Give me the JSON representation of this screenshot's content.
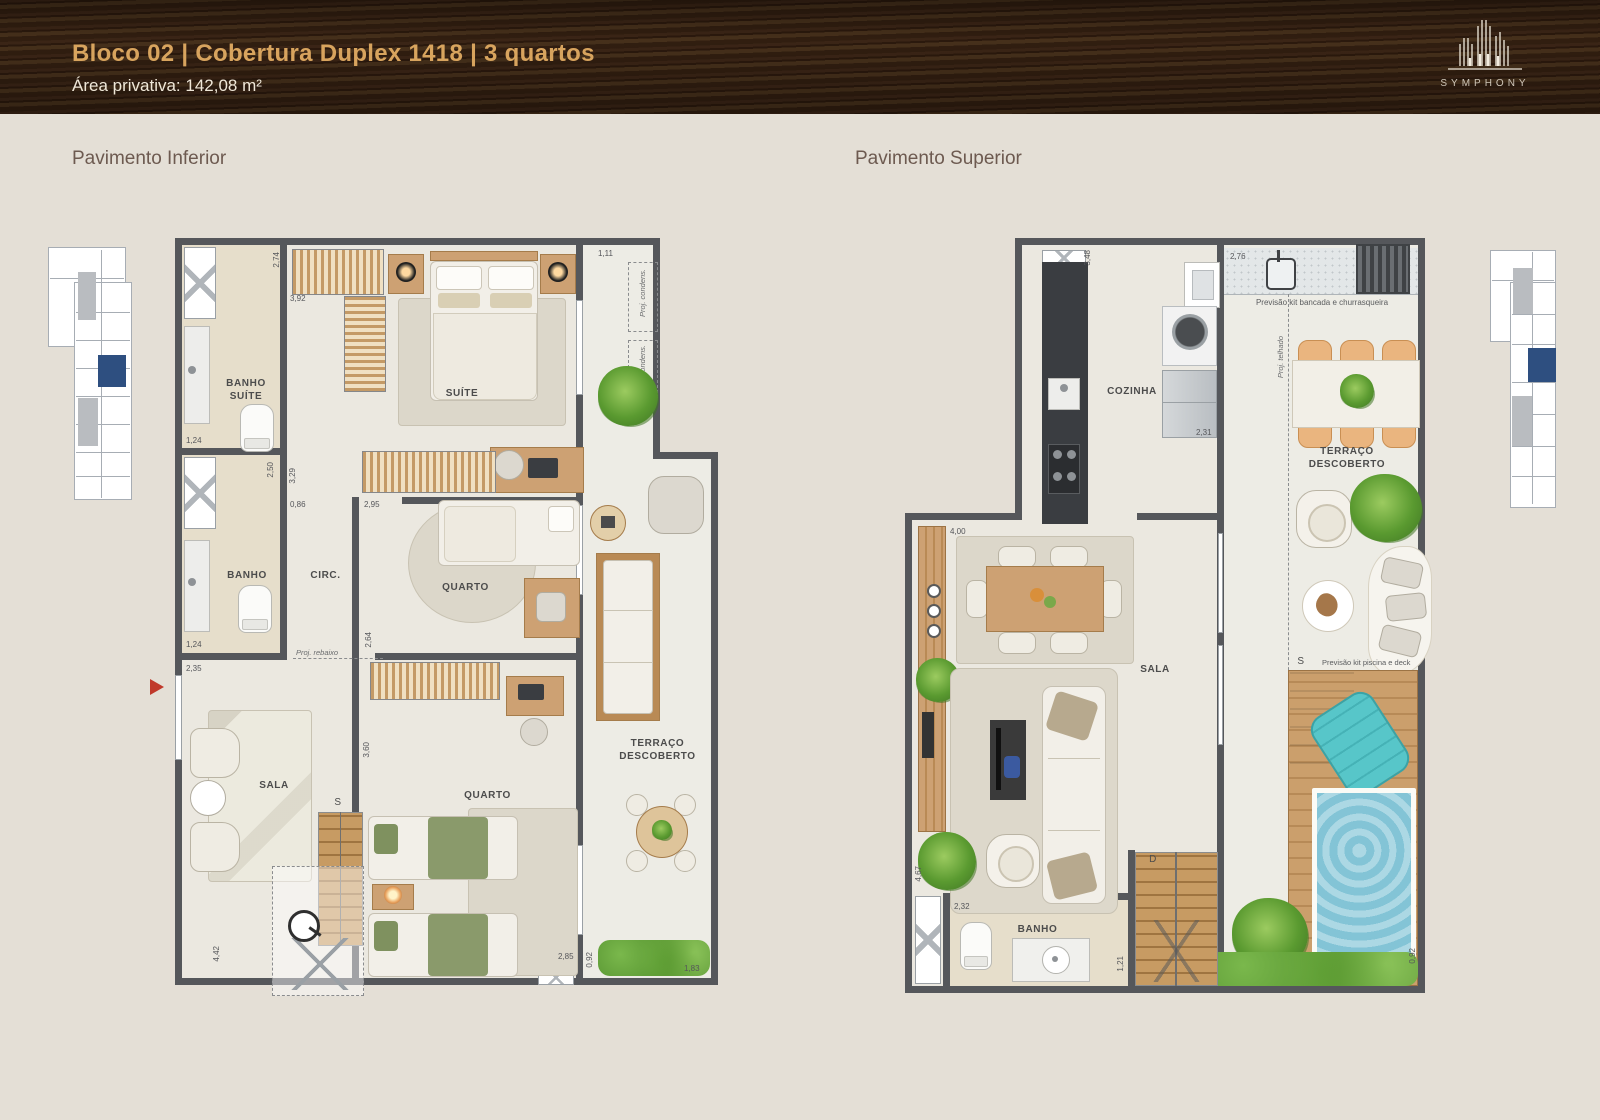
{
  "header": {
    "title": "Bloco 02 | Cobertura Duplex 1418 | 3 quartos",
    "subtitle": "Área privativa: 142,08 m²",
    "brand": "SYMPHONY"
  },
  "sections": {
    "inferior_title": "Pavimento Inferior",
    "superior_title": "Pavimento Superior"
  },
  "colors": {
    "header_gold": "#d8a45e",
    "keyplan_highlight": "#2e4f80",
    "pool_water": "#8cc9da",
    "entry_arrow_red": "#c0392b"
  },
  "inferior": {
    "rooms": {
      "banho_suite": "BANHO\nSUÍTE",
      "suite": "SUÍTE",
      "banho": "BANHO",
      "circ": "CIRC.",
      "quarto1": "QUARTO",
      "quarto2": "QUARTO",
      "sala": "SALA",
      "terraco": "TERRAÇO\nDESCOBERTO",
      "stair_s": "S"
    },
    "annotations": {
      "proj_rebaixo": "Proj. rebaixo",
      "proj_condens": "Proj. condens."
    },
    "dims": {
      "d1": "2,74",
      "d2": "3,92",
      "d3": "1,24",
      "d4": "2,50",
      "d5": "3,29",
      "d6": "0,86",
      "d7": "2,95",
      "d8": "2,64",
      "d9": "1,24",
      "d10": "2,35",
      "d11": "3,60",
      "d12": "4,42",
      "d13": "2,85",
      "d14": "0,92",
      "d15": "1,83",
      "d16": "1,11"
    }
  },
  "superior": {
    "rooms": {
      "cozinha": "COZINHA",
      "sala": "SALA",
      "banho": "BANHO",
      "terraco": "TERRAÇO\nDESCOBERTO",
      "stair_d": "D",
      "stair_s": "S"
    },
    "annotations": {
      "bancada": "Previsão kit bancada e churrasqueira",
      "piscina": "Previsão kit piscina e deck",
      "proj_telhado": "Proj. telhado"
    },
    "dims": {
      "d1": "3,48",
      "d2": "2,76",
      "d3": "2,31",
      "d4": "4,00",
      "d5": "4,67",
      "d6": "2,32",
      "d7": "1,21",
      "d8": "0,92"
    }
  }
}
